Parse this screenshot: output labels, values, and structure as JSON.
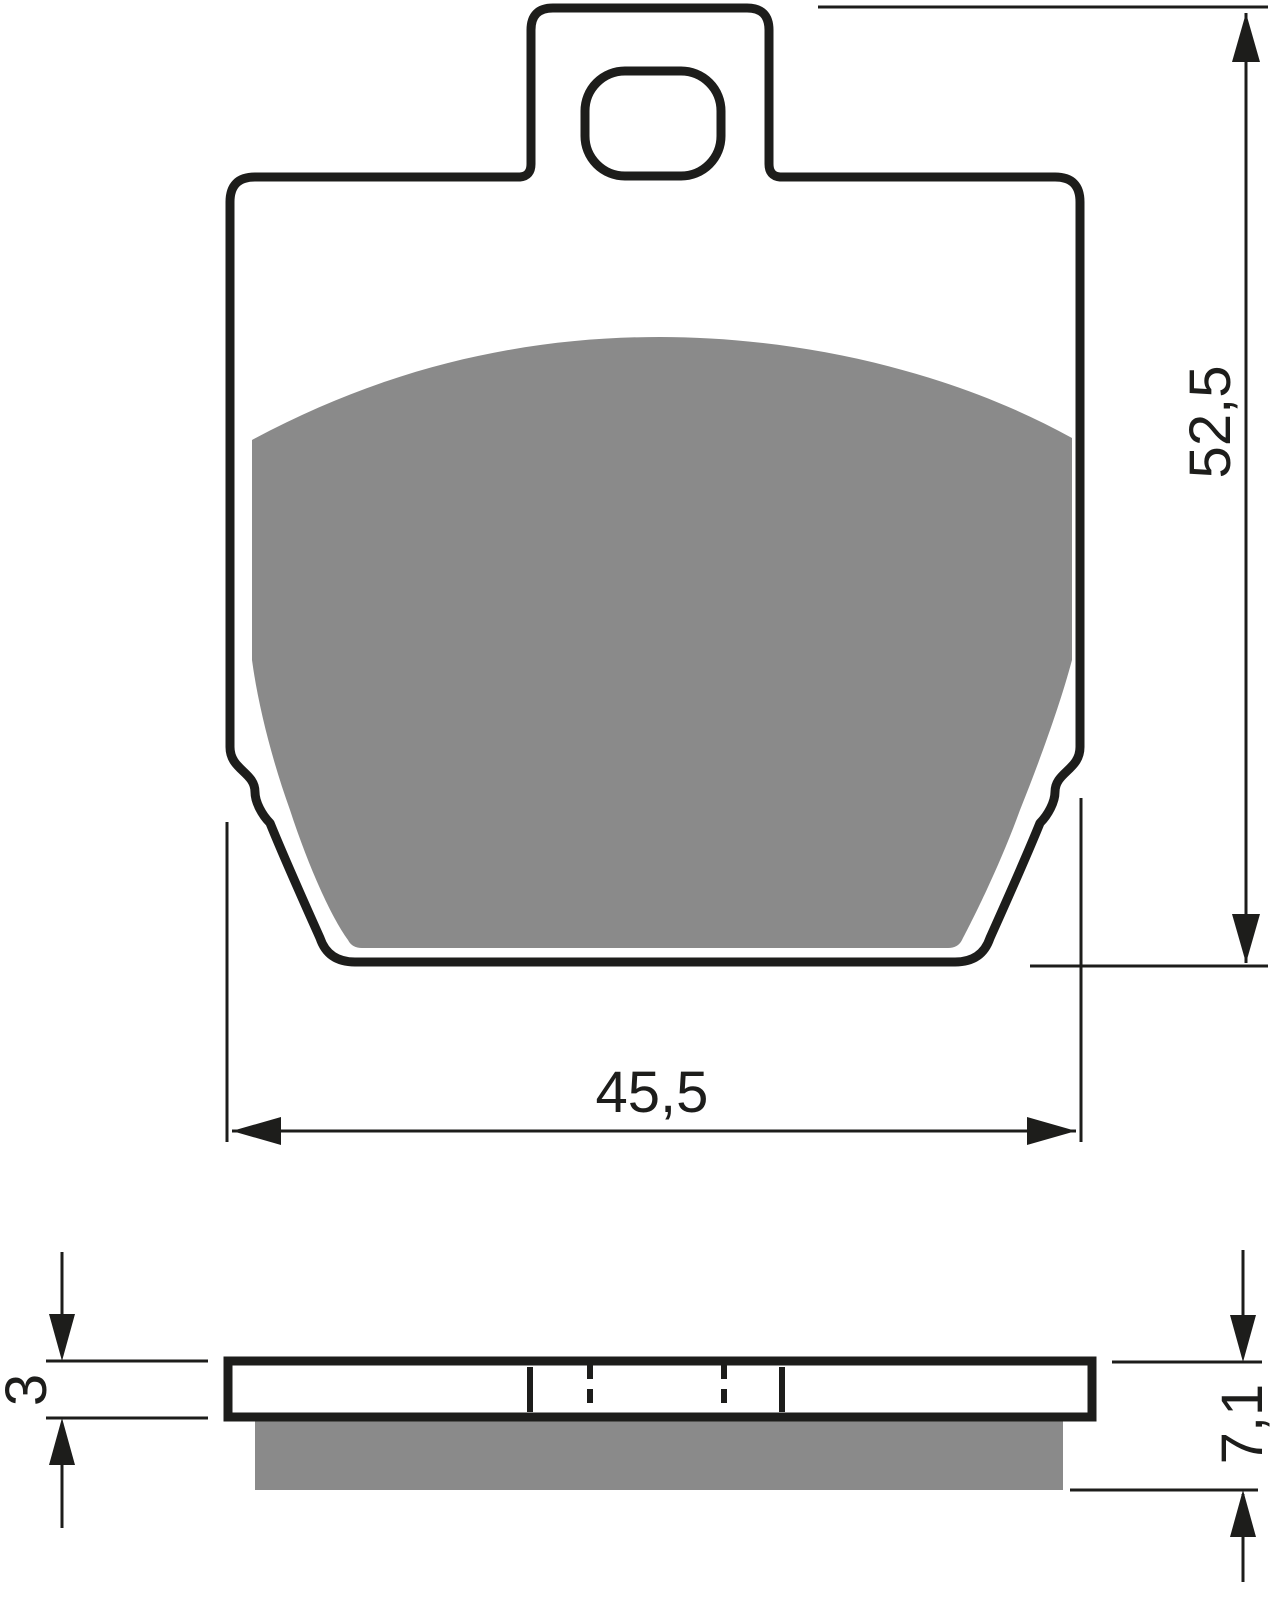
{
  "drawing": {
    "front_view": {
      "height_dimension_label": "52,5",
      "width_dimension_label": "45,5"
    },
    "side_view": {
      "backplate_thickness_label": "3",
      "overall_thickness_label": "7,1"
    },
    "colors": {
      "line": "#1d1d1b",
      "friction_material": "#8a8a8a",
      "background": "#ffffff"
    }
  }
}
